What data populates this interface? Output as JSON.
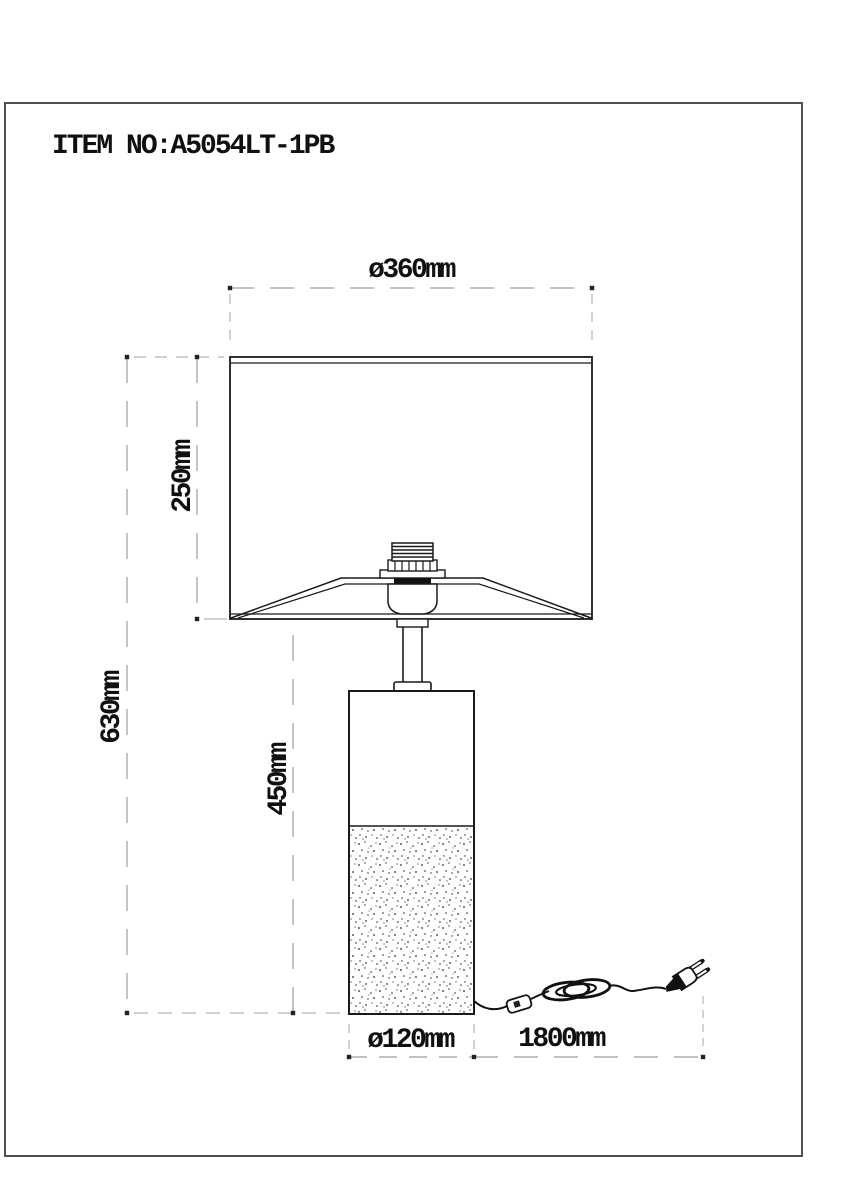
{
  "page": {
    "item_label": "ITEM NO:A5054LT-1PB"
  },
  "dimensions": {
    "shade_diameter": "ø360mm",
    "shade_height": "250mm",
    "total_height": "630mm",
    "body_height": "450mm",
    "base_diameter": "ø120mm",
    "cord_length": "1800mm"
  },
  "colors": {
    "object_line": "#1a1a1a",
    "dimension_line": "#9b9b9b",
    "extension_line": "#b5b5b5",
    "text": "#101010",
    "border": "#4f4f4f",
    "background": "#ffffff"
  }
}
